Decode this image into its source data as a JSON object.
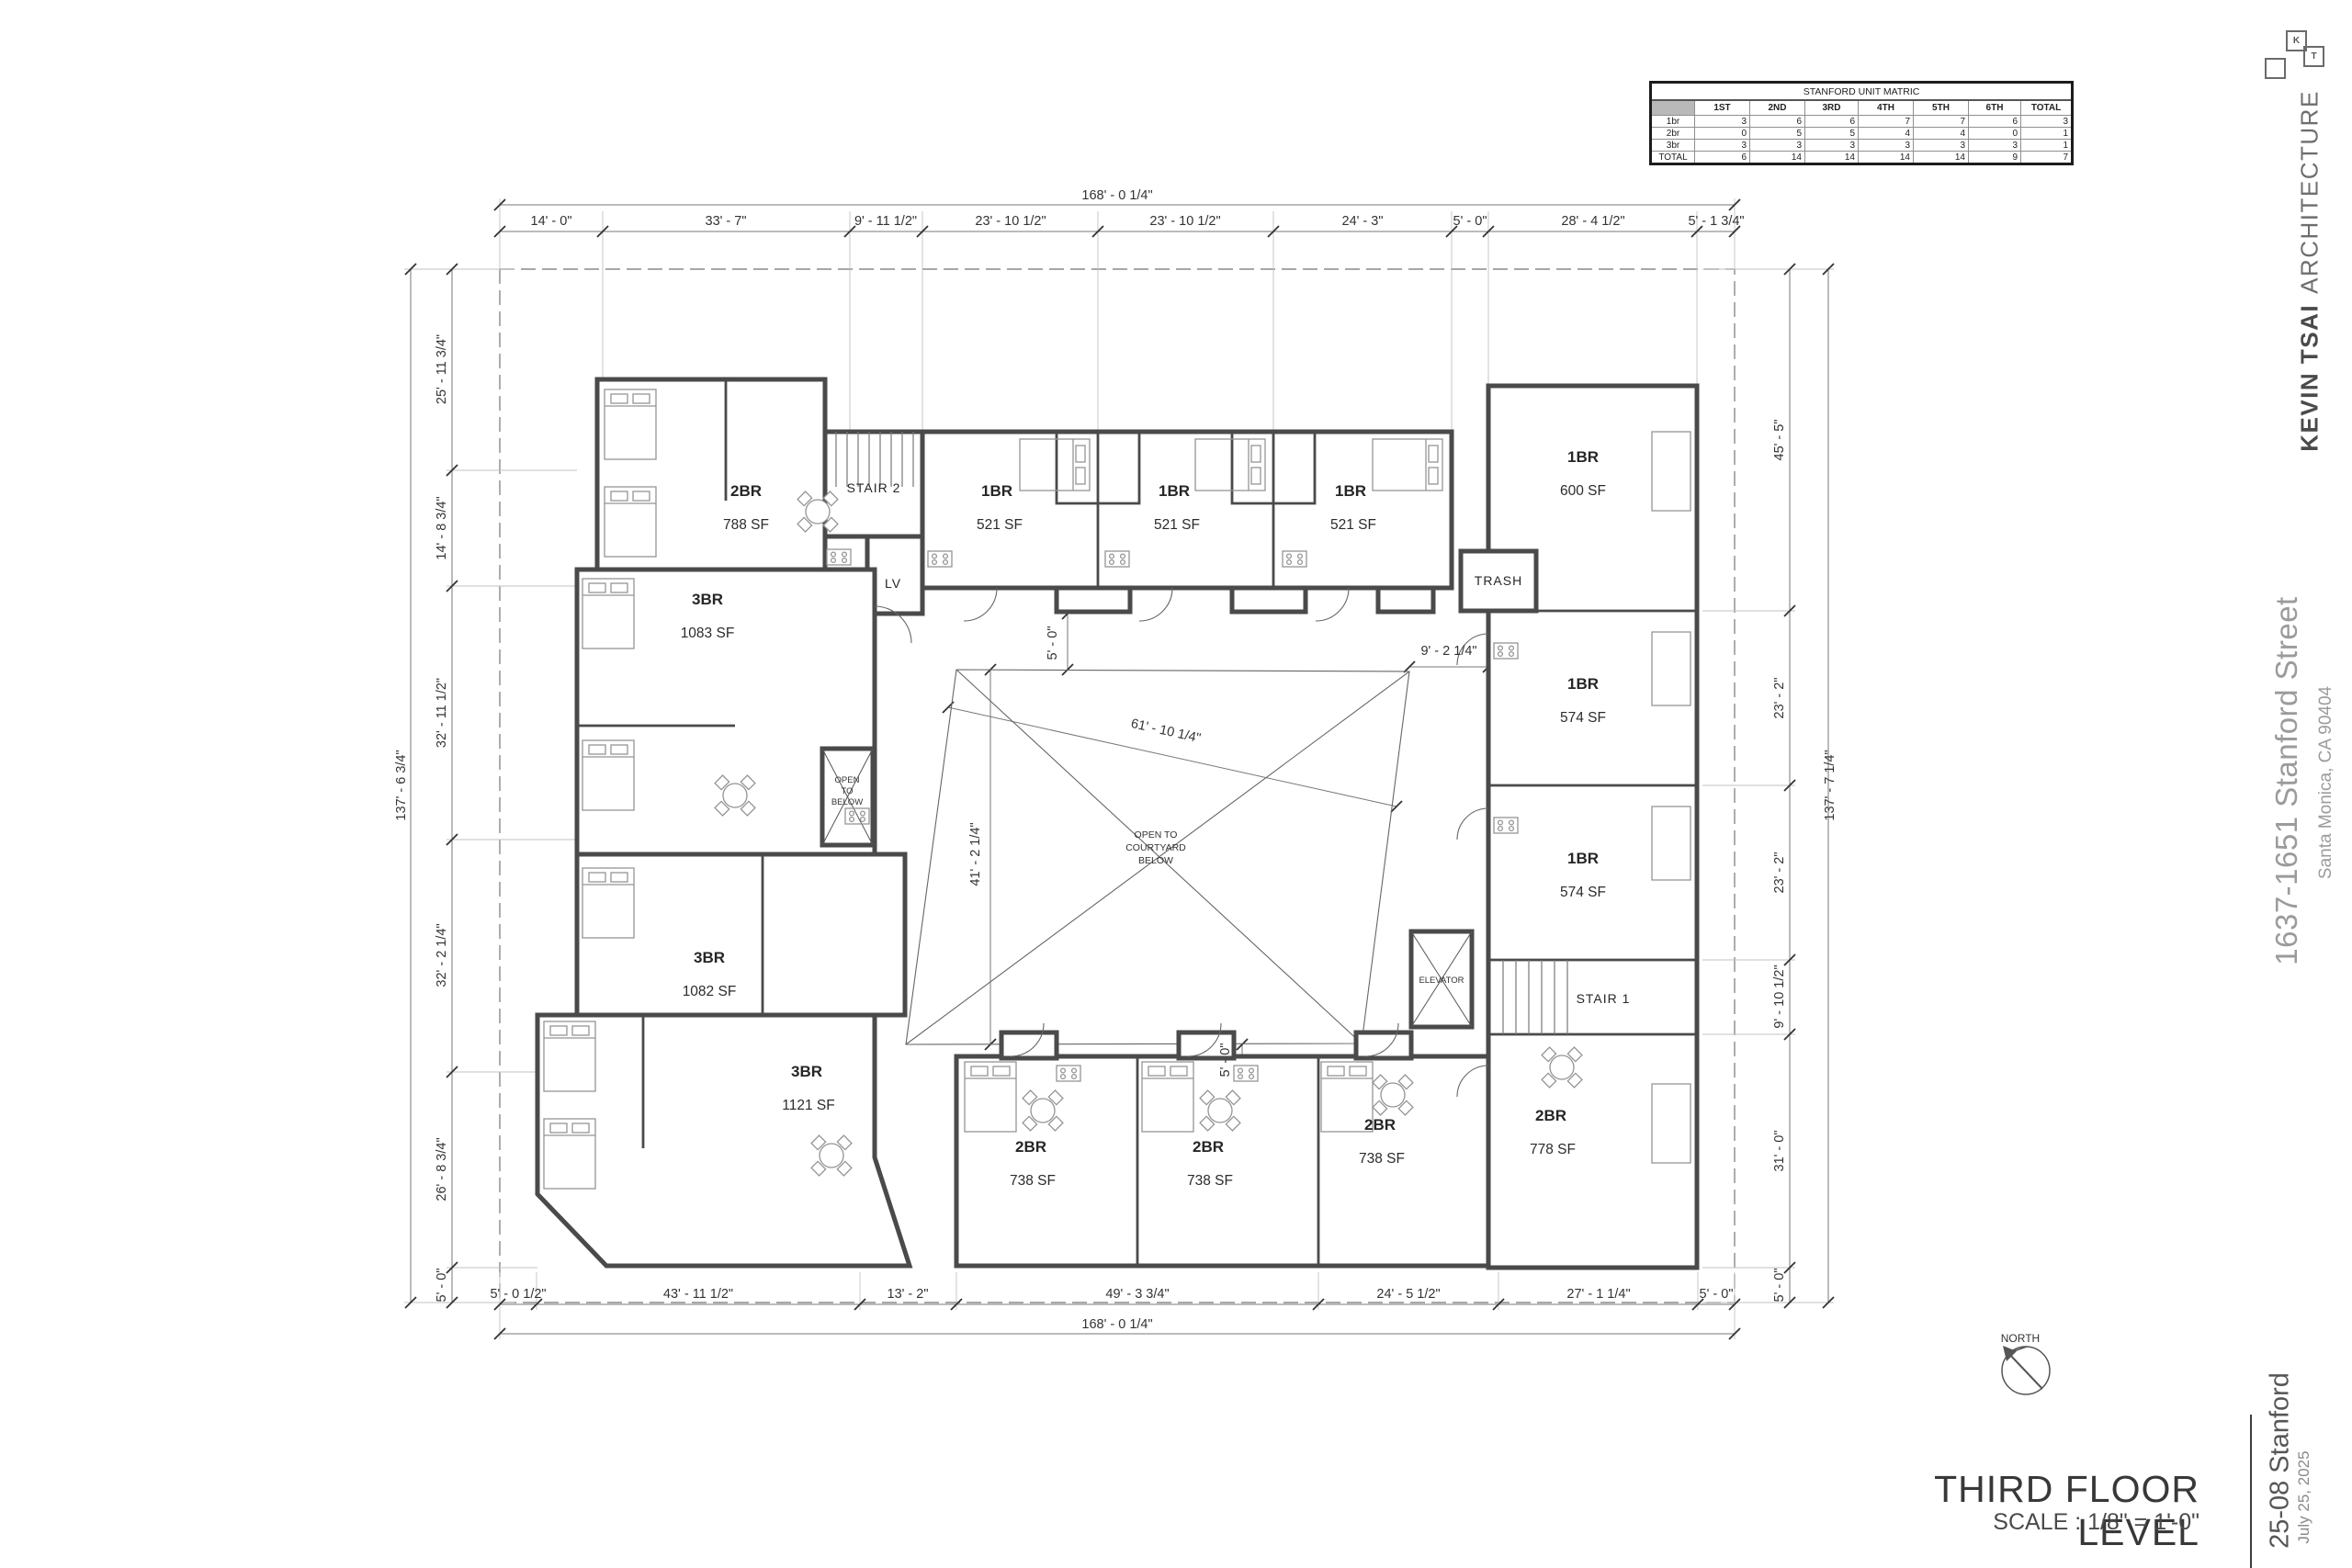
{
  "matrix": {
    "title": "STANFORD UNIT MATRIC",
    "headers": [
      "",
      "1ST",
      "2ND",
      "3RD",
      "4TH",
      "5TH",
      "6TH",
      "TOTAL"
    ],
    "rows": [
      {
        "label": "1br",
        "cells": [
          "3",
          "6",
          "6",
          "7",
          "7",
          "6",
          "3"
        ]
      },
      {
        "label": "2br",
        "cells": [
          "0",
          "5",
          "5",
          "4",
          "4",
          "0",
          "1"
        ]
      },
      {
        "label": "3br",
        "cells": [
          "3",
          "3",
          "3",
          "3",
          "3",
          "3",
          "1"
        ]
      },
      {
        "label": "TOTAL",
        "cells": [
          "6",
          "14",
          "14",
          "14",
          "14",
          "9",
          "7"
        ]
      }
    ]
  },
  "titleblock": {
    "logo_k": "K",
    "logo_t": "T",
    "firm_bold": "KEVIN TSAI",
    "firm_rest": "ARCHITECTURE",
    "street": "1637-1651 Stanford Street",
    "city": "Santa Monica, CA 90404",
    "project": "25-08 Stanford",
    "date": "July 25, 2025",
    "sheet_title": "THIRD FLOOR LEVEL",
    "sheet_scale": "SCALE : 1/8\" = 1'-0\""
  },
  "north_label": "NORTH",
  "dims": {
    "top": {
      "overall": "168' - 0 1/4\"",
      "segments": [
        "14' - 0\"",
        "33' - 7\"",
        "9' - 11 1/2\"",
        "23' - 10 1/2\"",
        "23' - 10 1/2\"",
        "24' - 3\"",
        "5' - 0\"",
        "28' - 4 1/2\"",
        "5' - 1 3/4\""
      ]
    },
    "bottom": {
      "overall": "168' - 0 1/4\"",
      "segments": [
        "5' - 0 1/2\"",
        "43' - 11 1/2\"",
        "13' - 2\"",
        "49' - 3 3/4\"",
        "24' - 5 1/2\"",
        "27' - 1 1/4\"",
        "5' - 0\""
      ]
    },
    "left": {
      "overall": "137' - 6 3/4\"",
      "segments": [
        "25' - 11 3/4\"",
        "14' - 8 3/4\"",
        "32' - 11 1/2\"",
        "32' - 2 1/4\"",
        "26' - 8 3/4\"",
        "5' - 0\""
      ]
    },
    "right": {
      "overall": "137' - 7 1/4\"",
      "segments": [
        "45' - 5\"",
        "23' - 2\"",
        "23' - 2\"",
        "9' - 10 1/2\"",
        "31' - 0\"",
        "5' - 0\""
      ]
    },
    "courtyard": {
      "diag": "61' - 10 1/4\"",
      "height": "41' - 2 1/4\"",
      "gap_right": "9' - 2 1/4\"",
      "gap_top": "5' - 0\"",
      "gap_bottom": "5' - 0\""
    }
  },
  "rooms": {
    "stair2": "STAIR 2",
    "stair1": "STAIR 1",
    "lv": "LV",
    "trash": "TRASH",
    "elevator": "ELEVATOR",
    "open_below": [
      "OPEN",
      "TO",
      "BELOW"
    ],
    "open_courtyard": [
      "OPEN TO",
      "COURTYARD",
      "BELOW"
    ]
  },
  "units": [
    {
      "type": "2BR",
      "area": "788 SF"
    },
    {
      "type": "3BR",
      "area": "1083 SF"
    },
    {
      "type": "3BR",
      "area": "1082 SF"
    },
    {
      "type": "3BR",
      "area": "1121 SF"
    },
    {
      "type": "1BR",
      "area": "521 SF"
    },
    {
      "type": "1BR",
      "area": "521 SF"
    },
    {
      "type": "1BR",
      "area": "521 SF"
    },
    {
      "type": "1BR",
      "area": "600 SF"
    },
    {
      "type": "1BR",
      "area": "574 SF"
    },
    {
      "type": "1BR",
      "area": "574 SF"
    },
    {
      "type": "2BR",
      "area": "778 SF"
    },
    {
      "type": "2BR",
      "area": "738 SF"
    },
    {
      "type": "2BR",
      "area": "738 SF"
    },
    {
      "type": "2BR",
      "area": "738 SF"
    }
  ]
}
